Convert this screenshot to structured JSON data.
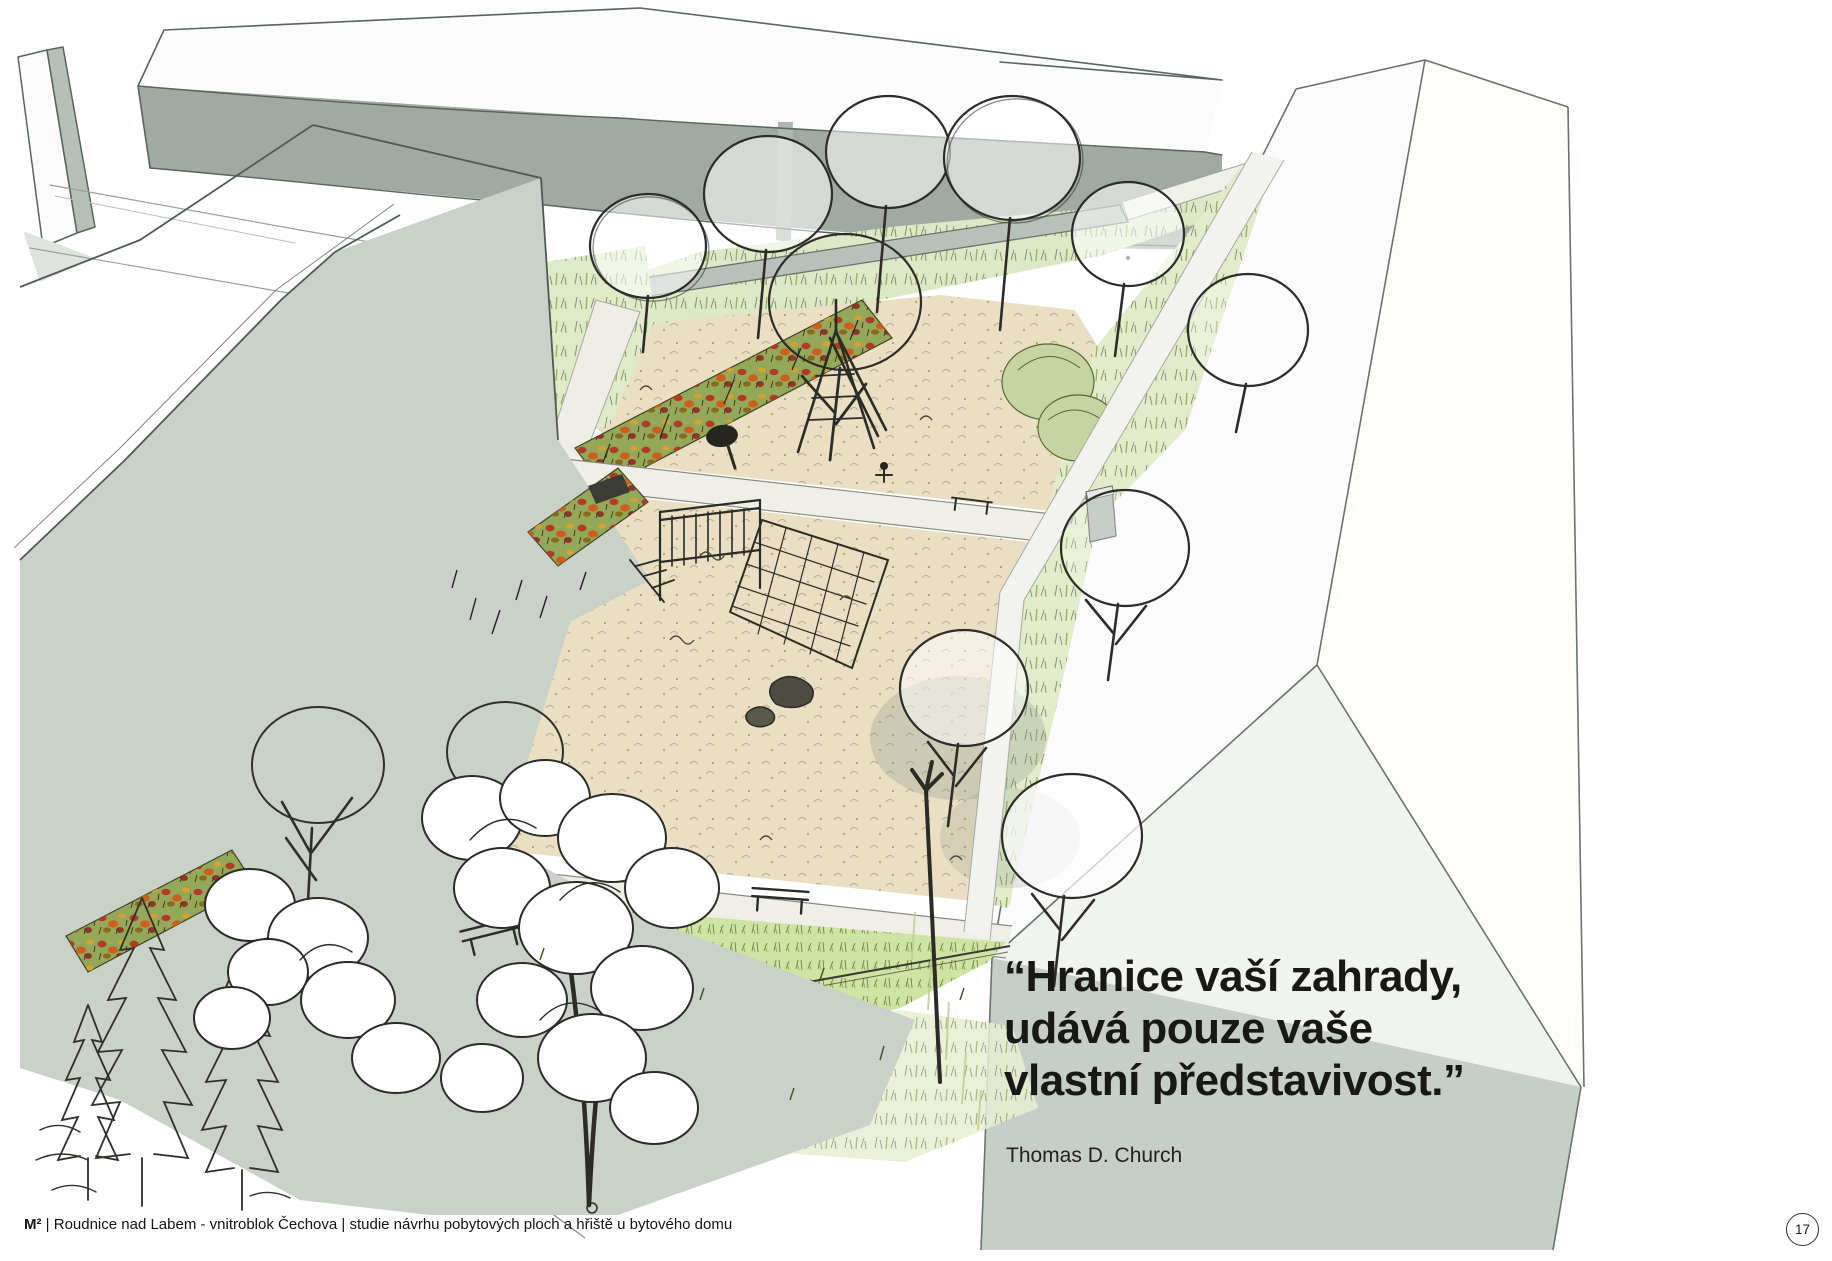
{
  "quote": {
    "lines": [
      "“Hranice vaší zahrady,",
      "udává pouze vaše",
      "vlastní představivost.”"
    ],
    "attribution": "Thomas D. Church"
  },
  "footer": {
    "brand": "M²",
    "text": " | Roudnice nad Labem - vnitroblok Čechova | studie návrhu pobytových ploch a hřiště u bytového domu"
  },
  "page_number": "17",
  "palette": {
    "paper": "#ffffff",
    "building_face_gray_green": "#c9d1c9",
    "right_facade_gray": "#c6cec7",
    "background_band_gray": "#a0aaa2",
    "wall_gray": "#b8c1b9",
    "sand": "#eadfc2",
    "path": "#efefe8",
    "lawn_green": "#cfe3a2",
    "meadow_green": "#e2ecca",
    "flowerbed_base": "#93a858",
    "flower_red": "#b23a24",
    "flower_orange": "#cf5e1d",
    "ink": "#2b2b28"
  }
}
